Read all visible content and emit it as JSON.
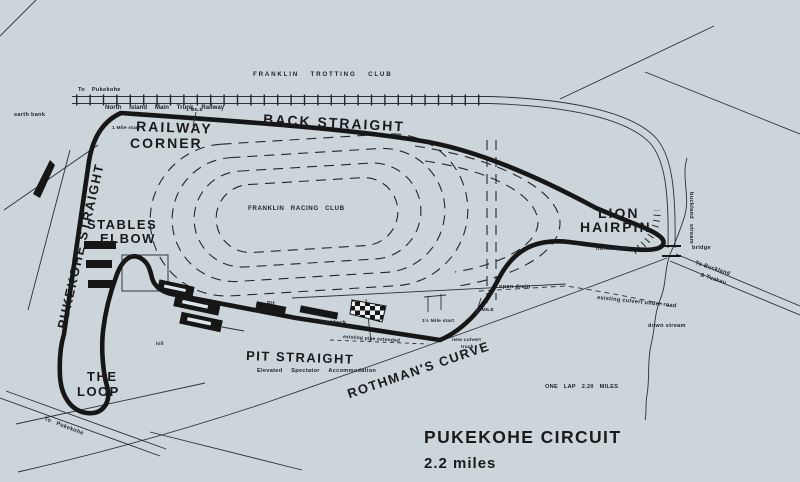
{
  "colors": {
    "paper": "#cbd5da",
    "ink": "#161616"
  },
  "title": {
    "name": "PUKEKOHE CIRCUIT",
    "distance": "2.2 miles",
    "lap_note": "ONE LAP 2.20 MILES"
  },
  "corner_labels": {
    "back_straight": "BACK STRAIGHT",
    "railway_corner_line1": "RAILWAY",
    "railway_corner_line2": "CORNER",
    "pukekohe_straight": "PUKEKOHE STRAIGHT",
    "stables_elbow_line1": "STABLES",
    "stables_elbow_line2": "ELBOW",
    "the_loop_line1": "THE",
    "the_loop_line2": "LOOP",
    "pit_straight": "PIT STRAIGHT",
    "rothmans_curve": "ROTHMAN'S CURVE",
    "lion_hairpin_line1": "LION",
    "lion_hairpin_line2": "HAIRPIN"
  },
  "venue_labels": {
    "trotting_club": "FRANKLIN TROTTING CLUB",
    "racing_club": "FRANKLIN RACING CLUB",
    "railway_name": "North Island Main Trunk Railway",
    "spectator": "Elevated Spectator Accommodation",
    "paddock": "Paddock",
    "pit": "Pit",
    "hill": "hill"
  },
  "road_labels": {
    "to_pukekohe_top": "To Pukekohe",
    "to_pukekohe_bottom": "To Pukekohe",
    "to_buckland_line1": "To Buckland",
    "to_buckland_line2": "& Tuakau",
    "bridge": "bridge"
  },
  "water_labels": {
    "stream": "buckland stream",
    "down_stream": "down stream",
    "open_drain": "open drain",
    "existing_culvert": "existing culvert under road",
    "new_culvert_line1": "new culvert",
    "new_culvert_line2": "track",
    "existing_pipe": "existing pipe extended"
  },
  "bank_labels": {
    "earth_bank": "earth bank",
    "north_bank": "north bank"
  },
  "distance_markers": {
    "one_mile_back": "1 MILE",
    "one_mile_rothmans": "1 MILE",
    "one_mile_start": "1 Mile start",
    "one_and_half_mile_start": "1½ Mile start"
  }
}
